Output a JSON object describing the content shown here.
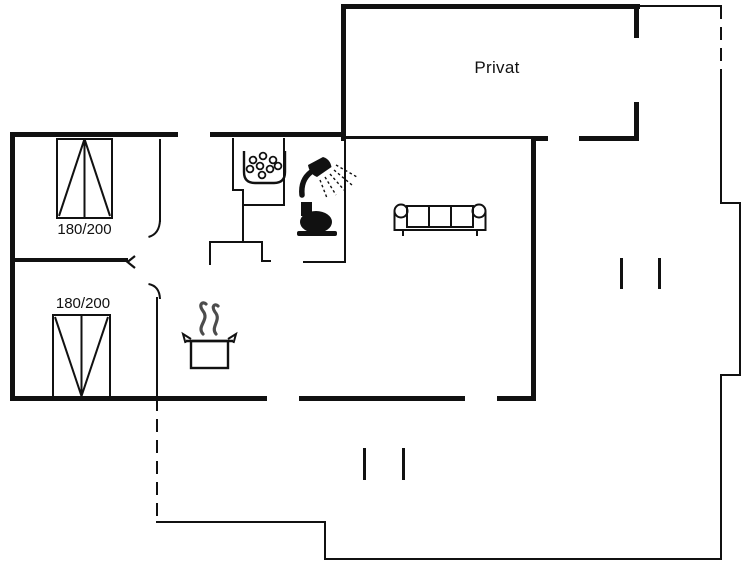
{
  "colors": {
    "background": "#ffffff",
    "line": "#111111"
  },
  "floorplan": {
    "privat_room_label": "Privat",
    "bedroom_top": {
      "bed_size_label": "180/200"
    },
    "bedroom_bottom": {
      "bed_size_label": "180/200"
    },
    "icons": [
      "stove-hob-icon",
      "shower-icon",
      "toilet-icon",
      "sofa-icon",
      "cooking-pot-icon",
      "window-opening-tick-icon",
      "door-swing-arc-icon"
    ]
  }
}
